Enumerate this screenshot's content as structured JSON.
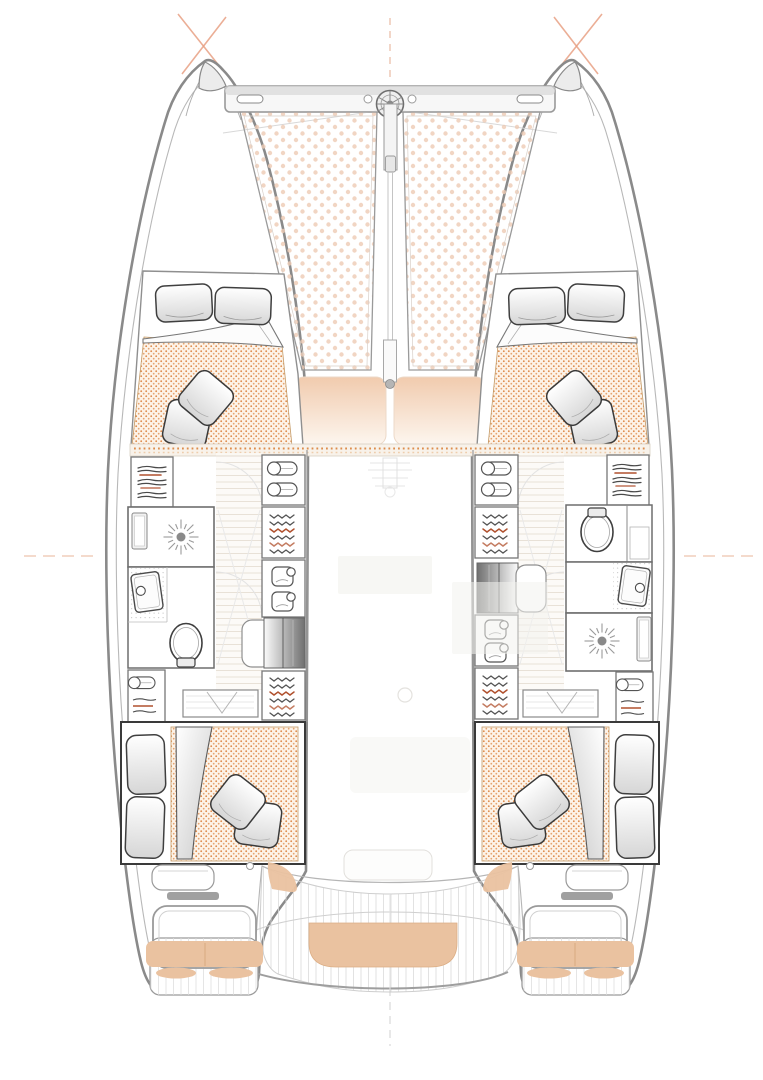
{
  "document": {
    "type": "catamaran-interior-layout-plan",
    "view": "top-down-deck-plan",
    "cabins": 4,
    "heads": 2
  },
  "colors": {
    "background": "#ffffff",
    "hull_outline": "#8a8a8a",
    "interior_wall": "#6e6e6e",
    "trampoline_dot": "#eecab4",
    "mattress_dot": "#dd8a4a",
    "mattress_bg": "#fdf3e8",
    "cushion_tan": "#eac2a0",
    "sunpad_top": "#f1cbae",
    "sunpad_bottom": "#fdf6ef",
    "accent_orange": "#d97c33",
    "clothes_accent": "#b0512e",
    "alignment_mark": "#e8a184",
    "wood_line": "#ded5c7",
    "steps_dark": "#6f6f6f"
  },
  "components": {
    "bow": [
      "bow-crossbeam",
      "windlass",
      "bowsprit",
      "trampoline-port",
      "trampoline-starboard"
    ],
    "foredeck": [
      "sunpad-port",
      "sunpad-starboard",
      "mast-step"
    ],
    "port_hull": [
      "forward-cabin",
      "wardrobe-shelves",
      "hanging-lockers",
      "shower-room",
      "sink",
      "toilet",
      "companionway-steps",
      "vanity-desk",
      "aft-cabin"
    ],
    "starboard_hull": [
      "forward-cabin",
      "wardrobe-shelves",
      "hanging-lockers",
      "toilet",
      "sink",
      "shower-room",
      "companionway-steps",
      "vanity-desk",
      "aft-cabin"
    ],
    "saloon": [
      "ghosted-furniture"
    ],
    "stern": [
      "cockpit-deck",
      "center-bench",
      "transom-seat-port",
      "transom-seat-starboard",
      "swim-platform-port",
      "swim-platform-starboard"
    ]
  }
}
